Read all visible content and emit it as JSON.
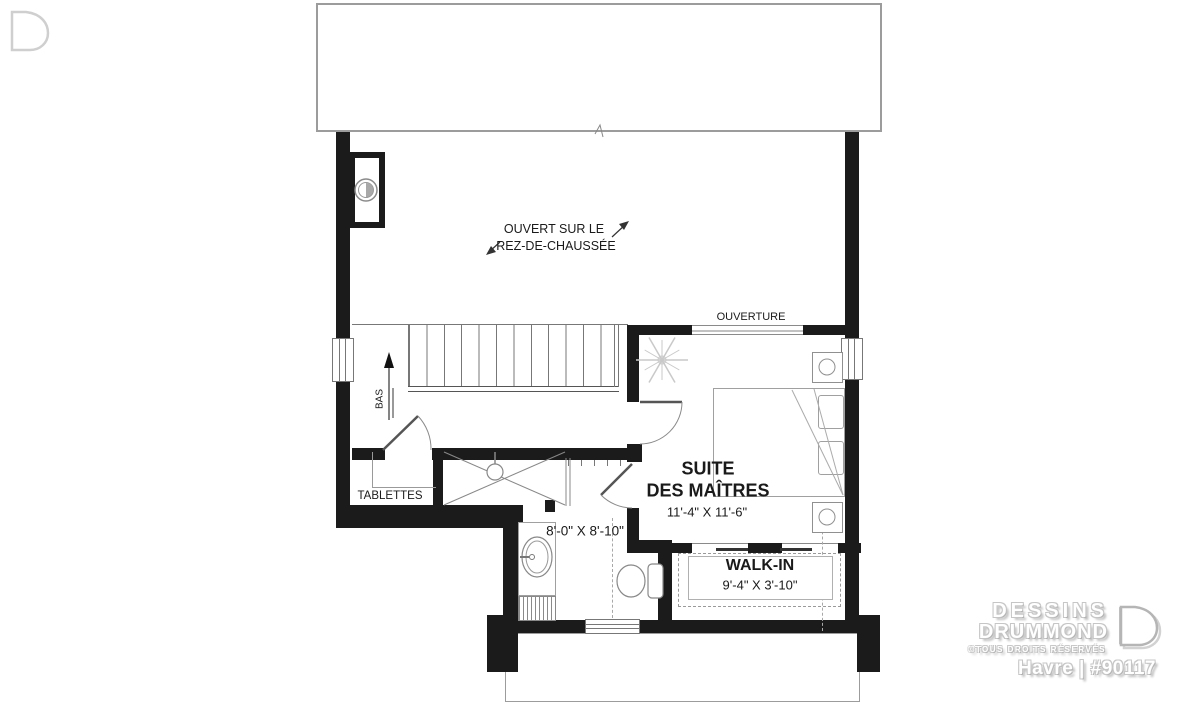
{
  "plan": {
    "annotations": {
      "open_below_1": "OUVERT SUR LE",
      "open_below_2": "REZ-DE-CHAUSSÉE",
      "ouverture": "OUVERTURE",
      "stairs_down": "BAS"
    },
    "rooms": {
      "master_suite": {
        "name_line1": "SUITE",
        "name_line2": "DES MAÎTRES",
        "dimensions": "11'-4\" X 11'-6\""
      },
      "walk_in": {
        "name": "WALK-IN",
        "dimensions": "9'-4\" X 3'-10\""
      },
      "bathroom": {
        "dimensions": "8'-0\" X 8'-10\""
      },
      "closet": {
        "label": "TABLETTES"
      }
    }
  },
  "footer": {
    "brand_line1": "DESSINS",
    "brand_line2": "DRUMMOND",
    "rights": "©TOUS DROITS RÉSERVÉS",
    "plan_name": "Havre | #90117"
  }
}
